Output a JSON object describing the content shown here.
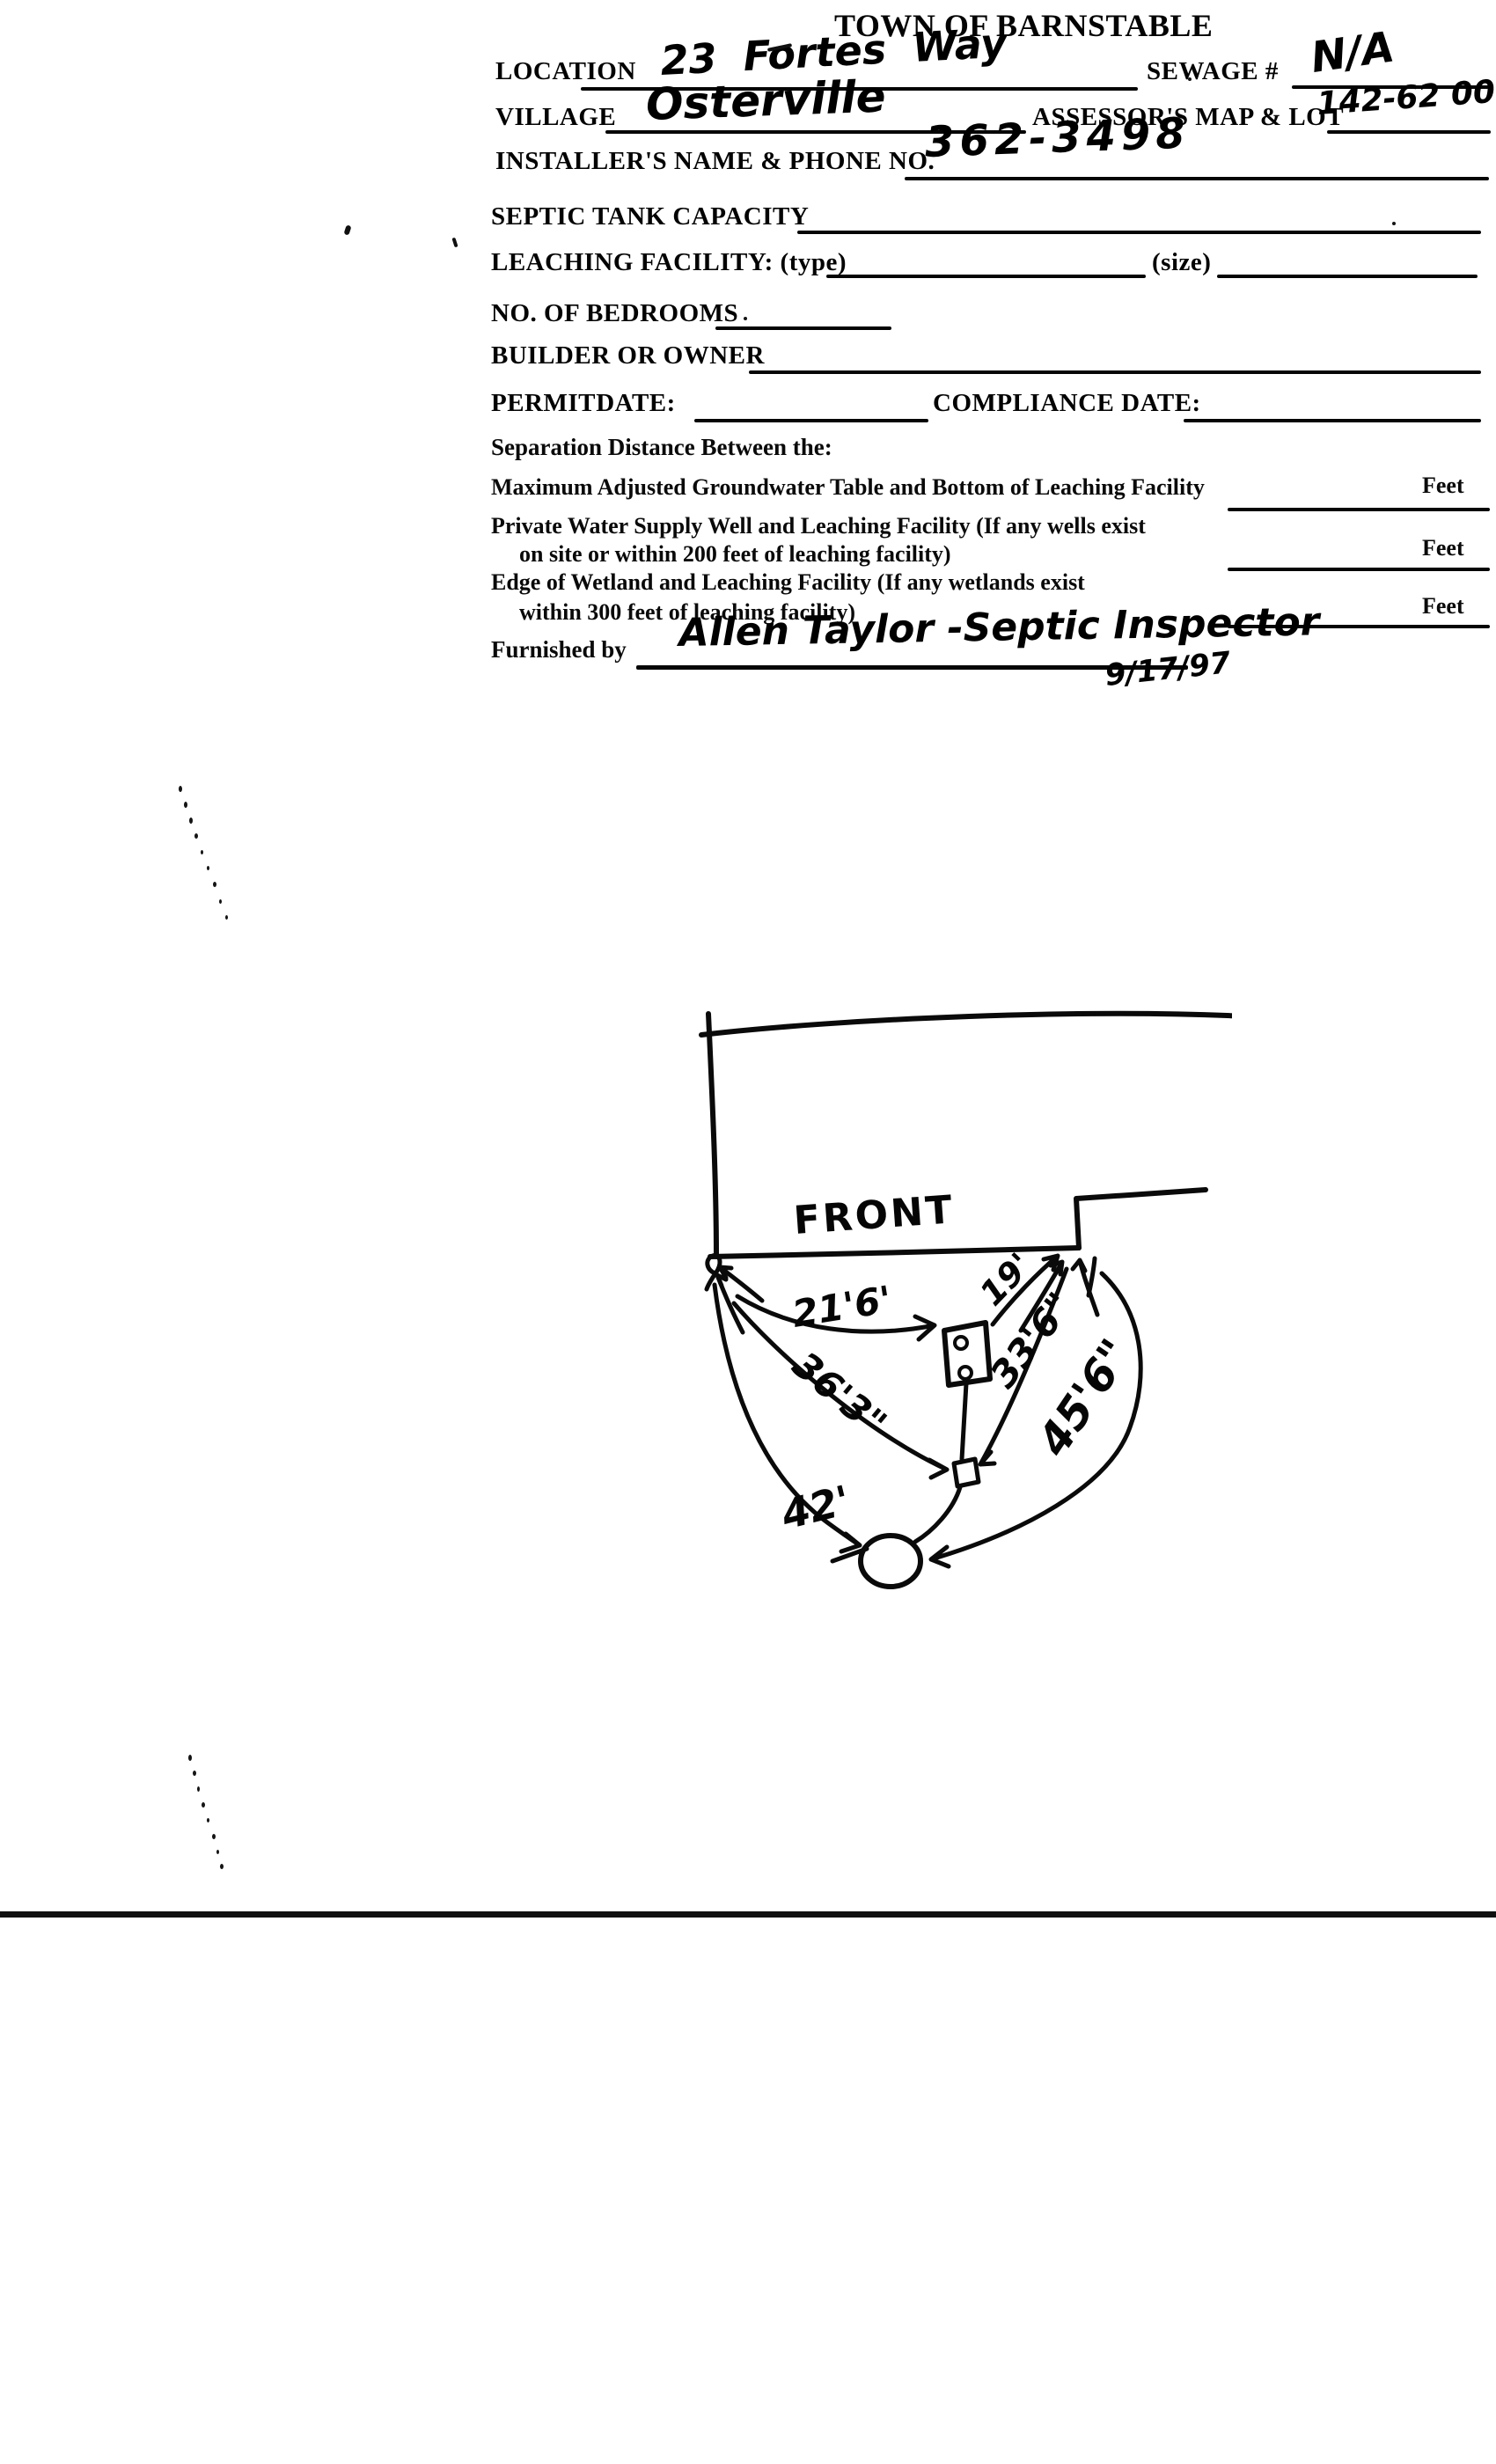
{
  "document": {
    "title": "TOWN OF BARNSTABLE",
    "fields": {
      "location": {
        "label": "LOCATION",
        "value": "23 Fortes Way"
      },
      "sewage_number": {
        "label": "SEWAGE #",
        "value": "N/A"
      },
      "village": {
        "label": "VILLAGE",
        "value": "Osterville"
      },
      "assessors_map_lot": {
        "label": "ASSESSOR'S MAP & LOT",
        "value": "142-62 00"
      },
      "installer": {
        "label": "INSTALLER'S NAME & PHONE NO.",
        "value": "362-3498"
      },
      "septic_tank_capacity": {
        "label": "SEPTIC TANK CAPACITY",
        "value": ""
      },
      "leaching_facility": {
        "label": "LEACHING FACILITY: (type)",
        "size_label": "(size)",
        "type_value": "",
        "size_value": ""
      },
      "bedrooms": {
        "label": "NO. OF BEDROOMS",
        "value": ""
      },
      "builder_or_owner": {
        "label": "BUILDER OR OWNER",
        "value": ""
      },
      "permit_date": {
        "label": "PERMIT DATE:",
        "value": ""
      },
      "compliance_date": {
        "label": "COMPLIANCE DATE:",
        "value": ""
      }
    },
    "separation": {
      "heading": "Separation Distance Between the:",
      "rows": [
        {
          "line1": "Maximum Adjusted Groundwater Table and Bottom of Leaching Facility",
          "line2": "",
          "unit": "Feet",
          "value": ""
        },
        {
          "line1": "Private Water Supply Well and Leaching Facility  (If any wells exist",
          "line2": "on site or within 200 feet of leaching facility)",
          "unit": "Feet",
          "value": ""
        },
        {
          "line1": "Edge of Wetland and Leaching Facility (If any wetlands exist",
          "line2": "within 300 feet of leaching facility)",
          "unit": "Feet",
          "value": ""
        }
      ]
    },
    "furnished_by": {
      "label": "Furnished by",
      "value": "Allen Taylor  -Septic Inspector",
      "date": "9/17/97"
    }
  },
  "sketch": {
    "front_label": "FRONT",
    "dimensions": {
      "corner_to_tank": "21'6'",
      "tank_to_house": "19'",
      "corner_to_dbox": "36'3\"",
      "dbox_to_house": "33'6\"",
      "house_to_pit": "45'6\"",
      "corner_to_pit": "42'"
    }
  }
}
